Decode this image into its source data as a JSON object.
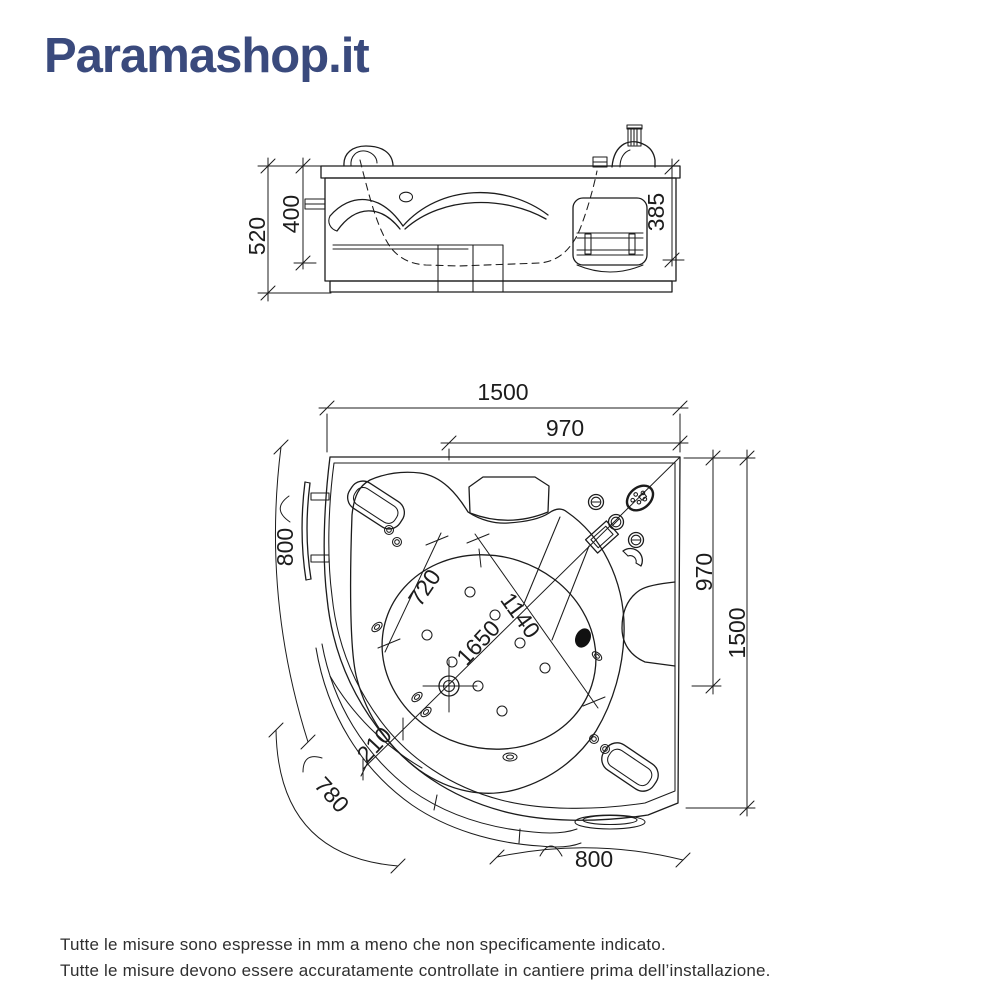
{
  "logo": {
    "text": "Paramashop.it"
  },
  "colors": {
    "logo": "#3a4a7d",
    "line": "#1c1c1c",
    "footer_text": "#2f2f2f"
  },
  "elevation": {
    "dim_total_height": "520",
    "dim_inner_height": "400",
    "dim_right_height": "385"
  },
  "plan": {
    "dim_width_total": "1500",
    "dim_width_corner": "970",
    "dim_arc_left": "800",
    "dim_arc_corner": "780",
    "dim_arc_bottom": "800",
    "dim_height_corner": "970",
    "dim_height_total": "1500",
    "dim_basin_length": "720",
    "dim_basin_width": "1140",
    "dim_diagonal": "1650",
    "dim_rim_offset": "210"
  },
  "footer": {
    "line1": "Tutte le misure sono espresse in mm a meno che non specificamente indicato.",
    "line2": "Tutte le misure devono essere accuratamente controllate in cantiere prima dell’installazione."
  }
}
